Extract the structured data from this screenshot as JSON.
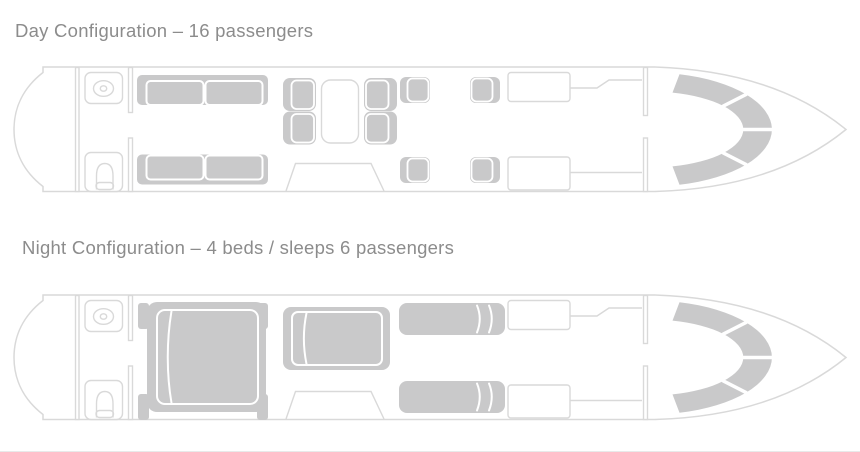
{
  "colors": {
    "background": "#ffffff",
    "outline": "#d9d9d9",
    "furniture_fill": "#c9c9ca",
    "seam_white": "#ffffff",
    "heading_text": "#8c8c8c",
    "bottom_divider": "#e8eaea"
  },
  "diagrams": [
    {
      "id": "day",
      "title": "Day Configuration – 16 passengers",
      "capacity_label": "16 passengers",
      "furniture": [
        "aft-lavatory-sink",
        "aft-lavatory-toilet",
        "three-seat-sofa-upper",
        "three-seat-sofa-lower",
        "conference-club-four-seats",
        "dining-table",
        "facing-club-two-seats-upper",
        "facing-club-two-seats-lower",
        "entry-door",
        "galley-cabinets",
        "cockpit-seats"
      ]
    },
    {
      "id": "night",
      "title": "Night Configuration – 4 beds / sleeps 6 passengers",
      "beds_label": "4 beds",
      "sleeps_label": "sleeps 6 passengers",
      "furniture": [
        "aft-lavatory-sink",
        "aft-lavatory-toilet",
        "double-bed-aft",
        "double-bed-mid",
        "single-berth-upper",
        "single-berth-lower",
        "entry-door",
        "galley-cabinets",
        "cockpit-seats"
      ]
    }
  ]
}
